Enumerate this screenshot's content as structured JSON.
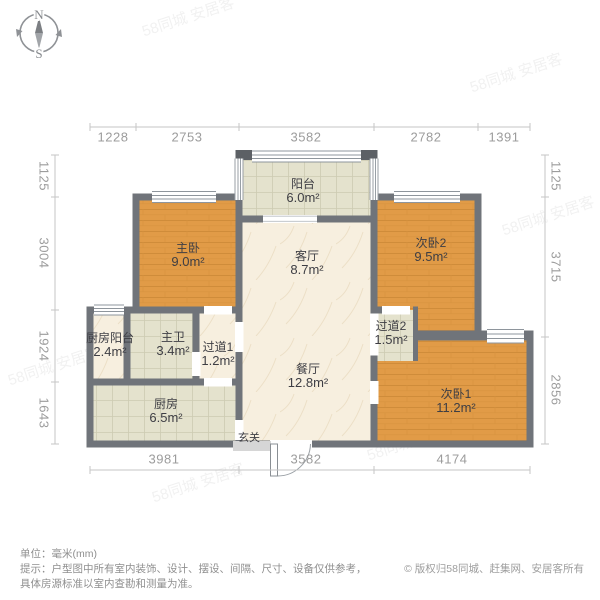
{
  "compass": {
    "north": "N",
    "south": "S"
  },
  "dimensions": {
    "unit_note": "单位：毫米(mm)",
    "top": [
      "1228",
      "2753",
      "3582",
      "2782",
      "1391"
    ],
    "bottom": [
      "3981",
      "3582",
      "4174"
    ],
    "left": [
      "1125",
      "3004",
      "1924",
      "1643"
    ],
    "right": [
      "1125",
      "3715",
      "2856"
    ]
  },
  "rooms": [
    {
      "name": "阳台",
      "area": "6.0m²"
    },
    {
      "name": "主卧",
      "area": "9.0m²"
    },
    {
      "name": "次卧2",
      "area": "9.5m²"
    },
    {
      "name": "客厅",
      "area": "8.7m²"
    },
    {
      "name": "餐厅",
      "area": "12.8m²"
    },
    {
      "name": "厨房阳台",
      "area": "2.4m²"
    },
    {
      "name": "主卫",
      "area": "3.4m²"
    },
    {
      "name": "过道1",
      "area": "1.2m²"
    },
    {
      "name": "厨房",
      "area": "6.5m²"
    },
    {
      "name": "过道2",
      "area": "1.5m²"
    },
    {
      "name": "次卧1",
      "area": "11.2m²"
    },
    {
      "name": "玄关",
      "area": ""
    }
  ],
  "footer": {
    "line1": "单位：毫米(mm)",
    "line2": "提示：户型图中所有室内装饰、设计、摆设、间隔、尺寸、设备仅供参考，",
    "line3": "具体房源标准以室内查勘和测量为准。",
    "copyright": "© 版权归58同城、赶集网、安居客所有"
  },
  "watermark": {
    "text": "58同城 安居客"
  },
  "colors": {
    "wall": "#70747a",
    "wall_post": "#5c6065",
    "wood_floor": "#e19b47",
    "tile_floor": "#e4e2cd",
    "marble_floor": "#f7efdf",
    "dim_text": "#9c9c9c",
    "label_text": "#3e3e44"
  }
}
